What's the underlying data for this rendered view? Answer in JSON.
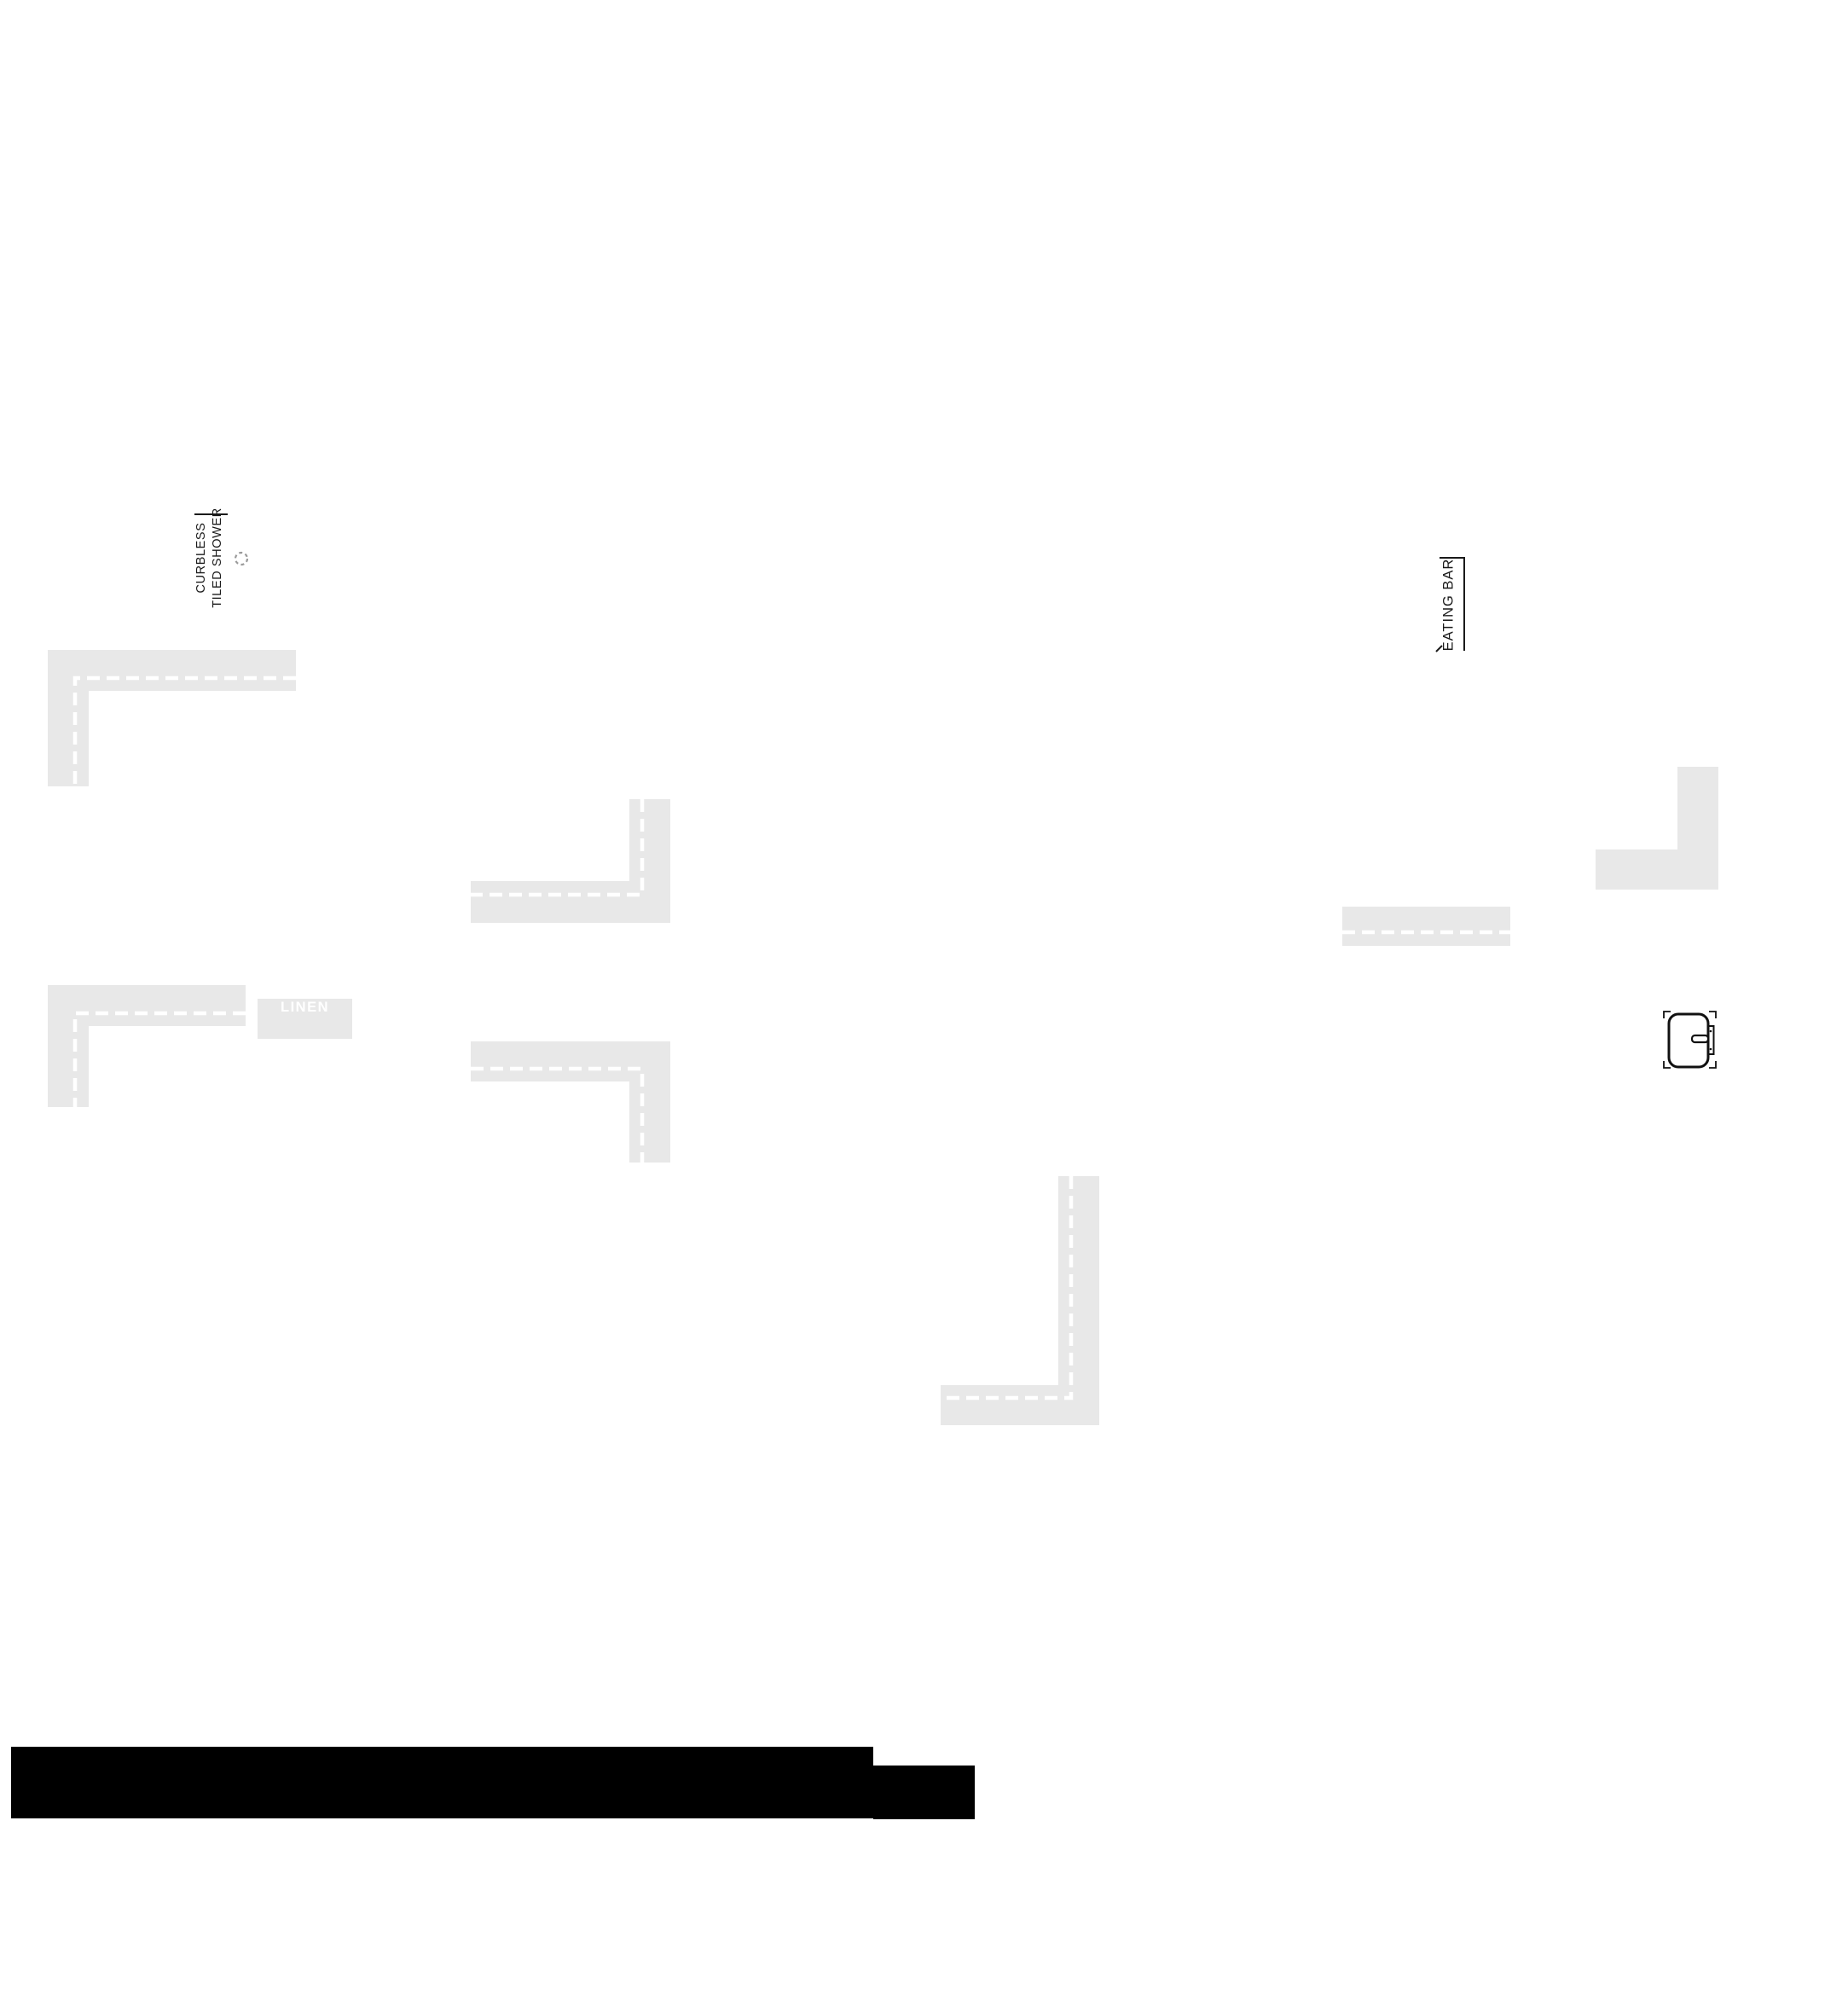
{
  "labels": {
    "curbless_shower": {
      "line1": "CURBLESS",
      "line2": "TILED SHOWER"
    },
    "eating_bar": "EATING BAR",
    "linen": "LINEN"
  },
  "colors": {
    "wall_fill": "#e8e8e8",
    "dash": "#ffffff",
    "ink": "#1a1a1a",
    "mass": "#000000",
    "linen_text": "#ffffff",
    "drain": "#9a9a9a"
  },
  "icons": {
    "shower_drain": "dashed-circle",
    "door": "rounded-door-leaf-with-latch-plate-and-handle"
  }
}
